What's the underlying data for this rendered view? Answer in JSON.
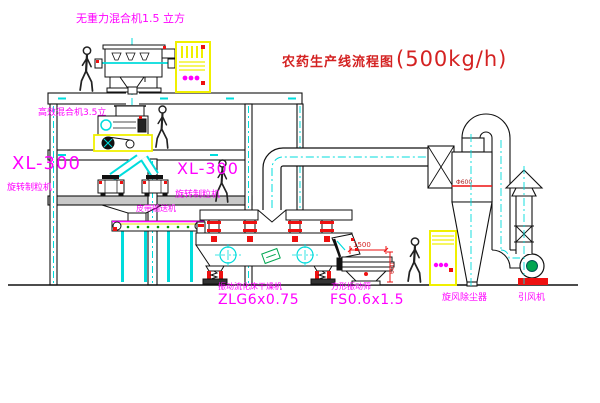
{
  "title": {
    "text": "农药生产线流程图",
    "capacity": "(500kg/h)"
  },
  "equipment": {
    "top_mixer": {
      "label": "无重力混合机1.5 立方"
    },
    "second_mixer": {
      "label": "高效混合机3.5立"
    },
    "granulator_left": {
      "model": "XL-300",
      "label": "旋转制粒机"
    },
    "granulator_right": {
      "model": "XL-300",
      "label": "旋转制粒机"
    },
    "belt_conveyor": {
      "label": "皮带输送机"
    },
    "fluid_bed_dryer": {
      "label": "振动流化床干燥机",
      "model": "ZLG6x0.75"
    },
    "vibrating_screen": {
      "label": "方形振动筛",
      "model": "FS0.6x1.5"
    },
    "cyclone": {
      "label": "旋风除尘器"
    },
    "fan": {
      "label": "引风机"
    }
  },
  "dimensions": {
    "screen_length": "1500",
    "screen_height": "600",
    "cyclone_dia": "Φ600"
  },
  "colors": {
    "label_magenta": "#ff00ff",
    "title_red": "#d42222",
    "line_black": "#111111",
    "centerline_cyan": "#00dcdc",
    "cabinet_yellow": "#f0f000",
    "accent_red": "#ee1111",
    "motor_green": "#00a651",
    "floor_gray": "#c8c8c8"
  }
}
